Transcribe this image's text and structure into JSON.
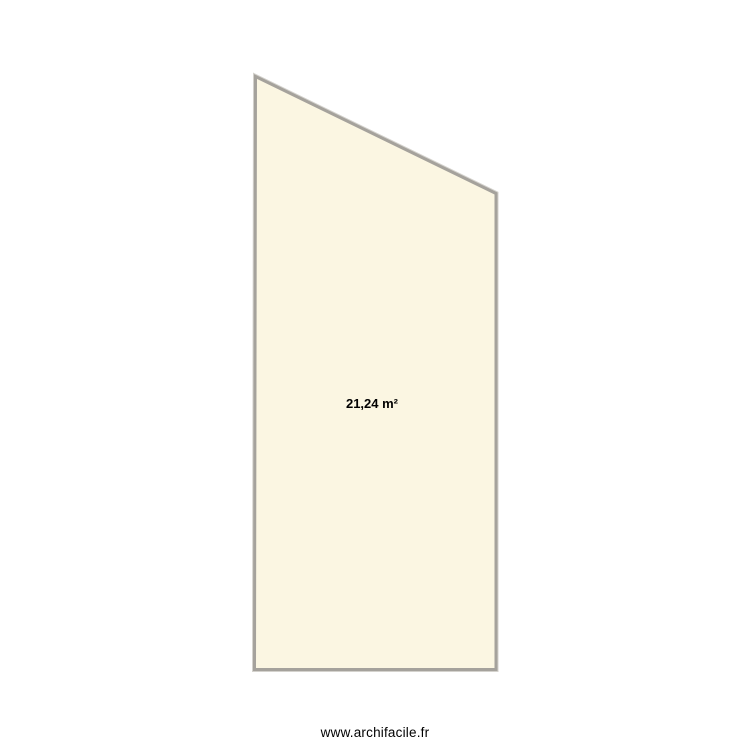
{
  "plan": {
    "room": {
      "area_label": "21,24 m²",
      "vertices": [
        [
          255.5,
          76.5
        ],
        [
          496,
          193.5
        ],
        [
          496,
          669.5
        ],
        [
          254.5,
          669.5
        ]
      ],
      "label_x": 372,
      "label_y": 408,
      "fill_color": "#fbf6e2",
      "wall_color": "#a5a29c",
      "wall_halo_color": "#d4d2cd"
    },
    "watermark": "www.archifacile.fr"
  }
}
